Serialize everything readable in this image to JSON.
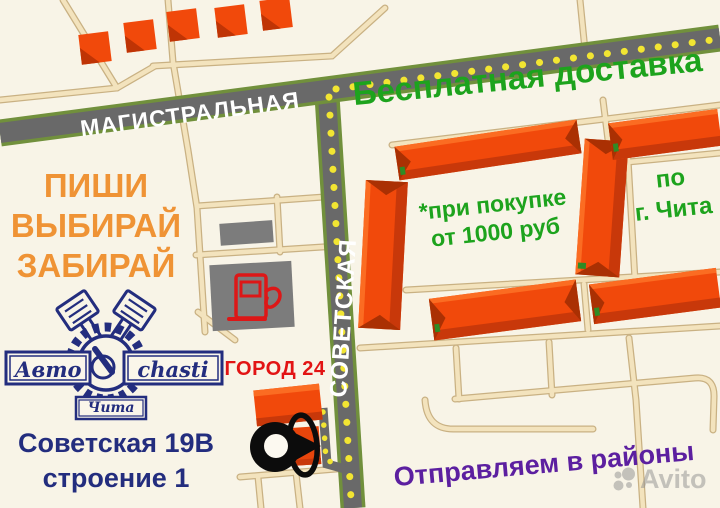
{
  "canvas": {
    "width": 720,
    "height": 508
  },
  "streets": {
    "horizontal_label": "МАГИСТРАЛЬНАЯ",
    "vertical_label": "СОВЕТСКАЯ"
  },
  "promo": {
    "free_delivery": "Бесплатная доставка",
    "condition_line1": "*при покупке",
    "condition_line2": "от 1000 руб",
    "coverage_line1": "по",
    "coverage_line2": "г. Чита",
    "slogan_line1": "ПИШИ",
    "slogan_line2": "ВЫБИРАЙ",
    "slogan_line3": "ЗАБИРАЙ",
    "shipping": "Отправляем в районы"
  },
  "landmark_label": "ГОРОД 24",
  "address": {
    "line1": "Советская 19В",
    "line2": "строение 1"
  },
  "logo": {
    "banner_left": "Авто",
    "banner_right": "chasti",
    "city_banner": "Чита"
  },
  "watermark": "Avito",
  "colors": {
    "background": "#f8f4e7",
    "road_gray": "#696969",
    "road_edge_green": "#71903c",
    "road_dash_yellow": "#f2e532",
    "minor_road_beige": "#f3e3bd",
    "building_orange": "#f1490b",
    "building_shadow": "#c8380a",
    "gas_station_gray": "#7c7c7c",
    "pump_red": "#dd1717",
    "text_green": "#1da31d",
    "text_orange": "#ef9335",
    "text_navy": "#232d7e",
    "text_red": "#e21414",
    "text_purple": "#5c1fa0"
  }
}
